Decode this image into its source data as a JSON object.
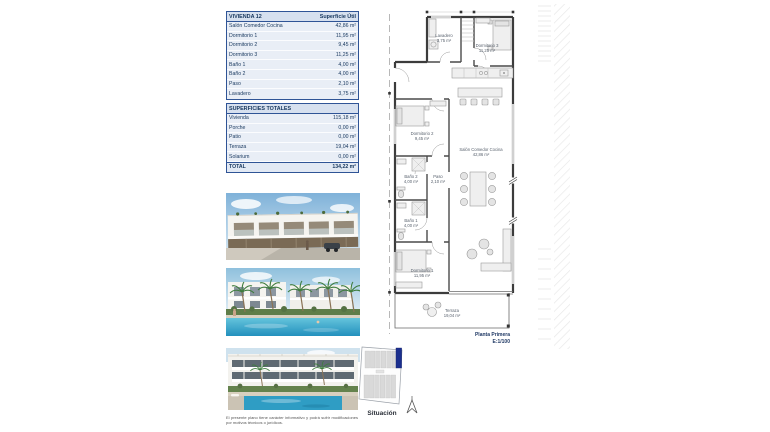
{
  "tables": {
    "vivienda": {
      "title": "VIVIENDA 12",
      "unit_header": "Superficie Útil",
      "rows": [
        {
          "label": "Salón Comedor Cocina",
          "value": "42,86 m²"
        },
        {
          "label": "Dormitorio 1",
          "value": "11,95 m²"
        },
        {
          "label": "Dormitorio 2",
          "value": "9,45 m²"
        },
        {
          "label": "Dormitorio 3",
          "value": "11,25 m²"
        },
        {
          "label": "Baño 1",
          "value": "4,00 m²"
        },
        {
          "label": "Baño 2",
          "value": "4,00 m²"
        },
        {
          "label": "Paso",
          "value": "2,10 m²"
        },
        {
          "label": "Lavadero",
          "value": "3,75 m²"
        }
      ]
    },
    "totales": {
      "title": "SUPERFICIES TOTALES",
      "rows": [
        {
          "label": "Vivienda",
          "value": "115,18 m²"
        },
        {
          "label": "Porche",
          "value": "0,00 m²"
        },
        {
          "label": "Patio",
          "value": "0,00 m²"
        },
        {
          "label": "Terraza",
          "value": "19,04 m²"
        },
        {
          "label": "Solarium",
          "value": "0,00 m²"
        }
      ],
      "total": {
        "label": "TOTAL",
        "value": "134,22 m²"
      }
    }
  },
  "floorplan": {
    "rooms": {
      "lavadero": {
        "name": "Lavadero",
        "area": "3,75 m²"
      },
      "dormitorio3": {
        "name": "Dormitorio 3",
        "area": "11,25 m²"
      },
      "dormitorio2": {
        "name": "Dormitorio 2",
        "area": "9,45 m²"
      },
      "salon": {
        "name": "Salón Comedor Cocina",
        "area": "42,86 m²"
      },
      "bano2": {
        "name": "Baño 2",
        "area": "4,00 m²"
      },
      "paso": {
        "name": "Paso",
        "area": "2,10 m²"
      },
      "bano1": {
        "name": "Baño 1",
        "area": "4,00 m²"
      },
      "dormitorio1": {
        "name": "Dormitorio 1",
        "area": "11,95 m²"
      },
      "terraza": {
        "name": "Terraza",
        "area": "19,04 m²"
      }
    },
    "plan_title": "Planta Primera",
    "plan_scale": "E:1/100"
  },
  "situacion": {
    "label": "Situación"
  },
  "disclaimer": "El presente plano tiene carácter informativo y podrá sufrir modificaciones por motivos técnicos o jurídicos.",
  "colors": {
    "accent_navy": "#17375e",
    "table_border": "#2f5496",
    "table_header_bg": "#d6e0ef",
    "table_row_bg": "#e9eef6",
    "highlight_unit": "#1b2f8e"
  }
}
